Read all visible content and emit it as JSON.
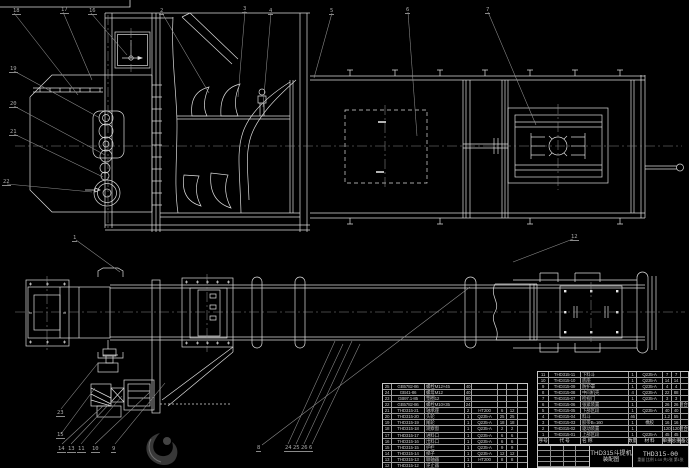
{
  "title_block": {
    "product_title": "THD315斗提机",
    "drawing_type": "装配图",
    "drawing_no": "THD315-00",
    "sheet_note": "重量  比例 1:10  共1张 第1张"
  },
  "colors": {
    "background": "#000000",
    "line": "#dcdcdc",
    "leader": "#8f8f8f",
    "table_line": "#9f9f9f",
    "text": "#c4c4c4",
    "watermark": "#383838"
  },
  "bom_right": {
    "header": [
      [
        "序号",
        "代 号",
        "名 称",
        "数量",
        "材 料",
        "单重",
        "总重",
        "备注"
      ]
    ],
    "rows": [
      [
        "11",
        "THD315-11",
        "下料斗",
        "1",
        "Q235-A",
        "7",
        "7",
        ""
      ],
      [
        "10",
        "THD315-10",
        "底座",
        "1",
        "Q235-A",
        "14",
        "14",
        ""
      ],
      [
        "9",
        "THD315-09",
        "防护罩",
        "1",
        "Q235-A",
        "4",
        "4",
        ""
      ],
      [
        "8",
        "THD315-08",
        "中间机壳",
        "4",
        "Q235-A",
        "22",
        "88",
        ""
      ],
      [
        "7",
        "THD315-07",
        "检视门",
        "1",
        "Q235-A",
        "3",
        "3",
        ""
      ],
      [
        "6",
        "THD315-06",
        "张紧装置",
        "1",
        "",
        "26",
        "26",
        "组合件"
      ],
      [
        "5",
        "THD315-05",
        "下部区段",
        "1",
        "Q235-A",
        "40",
        "40",
        ""
      ],
      [
        "4",
        "THD315-04",
        "料斗",
        "46",
        "",
        "1.2",
        "55",
        ""
      ],
      [
        "3",
        "THD315-03",
        "胶带B=160",
        "1",
        "橡胶",
        "16",
        "16",
        ""
      ],
      [
        "2",
        "THD315-02",
        "驱动装置",
        "1",
        "",
        "120",
        "120",
        "组合件"
      ],
      [
        "1",
        "THD315-01",
        "上部区段",
        "1",
        "Q235-A",
        "45",
        "45",
        ""
      ]
    ]
  },
  "bom_left": {
    "rows": [
      [
        "25",
        "GB5782-86",
        "螺栓M12×45",
        "40",
        "",
        "",
        "",
        ""
      ],
      [
        "24",
        "GB41-86",
        "螺母M12",
        "40",
        "",
        "",
        "",
        ""
      ],
      [
        "23",
        "GB97.1-85",
        "垫圈12",
        "80",
        "",
        "",
        "",
        ""
      ],
      [
        "22",
        "GB5782-86",
        "螺栓M10×35",
        "24",
        "",
        "",
        "",
        ""
      ],
      [
        "21",
        "THD315-21",
        "轴承座",
        "2",
        "HT200",
        "6",
        "12",
        ""
      ],
      [
        "20",
        "THD315-20",
        "头轮",
        "1",
        "Q235-A",
        "25",
        "25",
        ""
      ],
      [
        "19",
        "THD315-19",
        "尾轮",
        "1",
        "Q235-A",
        "18",
        "18",
        ""
      ],
      [
        "18",
        "THD315-18",
        "观察窗",
        "1",
        "Q235-A",
        "2",
        "2",
        ""
      ],
      [
        "17",
        "THD315-17",
        "进料口",
        "1",
        "Q235-A",
        "6",
        "6",
        ""
      ],
      [
        "16",
        "THD315-16",
        "出料口",
        "1",
        "Q235-A",
        "6",
        "6",
        ""
      ],
      [
        "15",
        "THD315-15",
        "护栏",
        "1",
        "Q235-A",
        "9",
        "9",
        ""
      ],
      [
        "14",
        "THD315-14",
        "梯子",
        "1",
        "Q235-A",
        "12",
        "12",
        ""
      ],
      [
        "13",
        "THD315-13",
        "联轴器",
        "1",
        "HT200",
        "8",
        "8",
        ""
      ],
      [
        "12",
        "THD315-12",
        "逆止器",
        "1",
        "",
        "",
        "",
        ""
      ]
    ]
  },
  "callouts": [
    {
      "x": 12,
      "y": 8,
      "t": "18"
    },
    {
      "x": 60,
      "y": 7,
      "t": "17"
    },
    {
      "x": 88,
      "y": 8,
      "t": "16"
    },
    {
      "x": 159,
      "y": 8,
      "t": "2"
    },
    {
      "x": 242,
      "y": 6,
      "t": "3"
    },
    {
      "x": 268,
      "y": 8,
      "t": "4"
    },
    {
      "x": 329,
      "y": 8,
      "t": "5"
    },
    {
      "x": 405,
      "y": 7,
      "t": "6"
    },
    {
      "x": 485,
      "y": 7,
      "t": "7"
    },
    {
      "x": 9,
      "y": 66,
      "t": "19"
    },
    {
      "x": 9,
      "y": 101,
      "t": "20"
    },
    {
      "x": 9,
      "y": 129,
      "t": "21"
    },
    {
      "x": 2,
      "y": 179,
      "t": "22"
    },
    {
      "x": 72,
      "y": 235,
      "t": "1"
    },
    {
      "x": 570,
      "y": 234,
      "t": "12"
    },
    {
      "x": 56,
      "y": 410,
      "t": "23"
    },
    {
      "x": 56,
      "y": 432,
      "t": "15"
    },
    {
      "x": 57,
      "y": 446,
      "t": "14"
    },
    {
      "x": 67,
      "y": 446,
      "t": "13"
    },
    {
      "x": 77,
      "y": 446,
      "t": "11"
    },
    {
      "x": 91,
      "y": 446,
      "t": "10"
    },
    {
      "x": 111,
      "y": 446,
      "t": "9"
    },
    {
      "x": 256,
      "y": 445,
      "t": "8"
    },
    {
      "x": 284,
      "y": 445,
      "t": "24"
    },
    {
      "x": 292,
      "y": 445,
      "t": "25"
    },
    {
      "x": 300,
      "y": 445,
      "t": "26"
    },
    {
      "x": 308,
      "y": 445,
      "t": "6"
    }
  ]
}
